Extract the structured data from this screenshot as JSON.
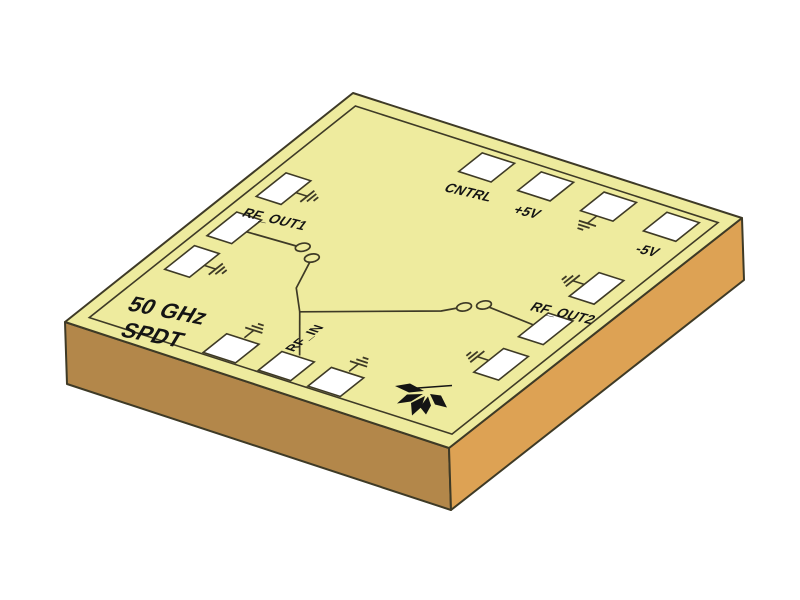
{
  "chip": {
    "die_label": {
      "line1": "50 GHz",
      "line2": "SPDT"
    },
    "pad_labels": {
      "cntrl": "CNTRL",
      "plus5": "+5V",
      "minus5": "-5V",
      "rf_out1": "RF_OUT1",
      "rf_out2": "RF_OUT2",
      "rf_in": "RF_IN"
    },
    "colors": {
      "background": "#ffffff",
      "top_face": "#eeeb9e",
      "left_face": "#b3874a",
      "right_face": "#dda254",
      "outline": "#3e3a26",
      "pad_fill": "#ffffff",
      "trace": "#3e3a26",
      "logo": "#141414",
      "text": "#141414"
    }
  }
}
